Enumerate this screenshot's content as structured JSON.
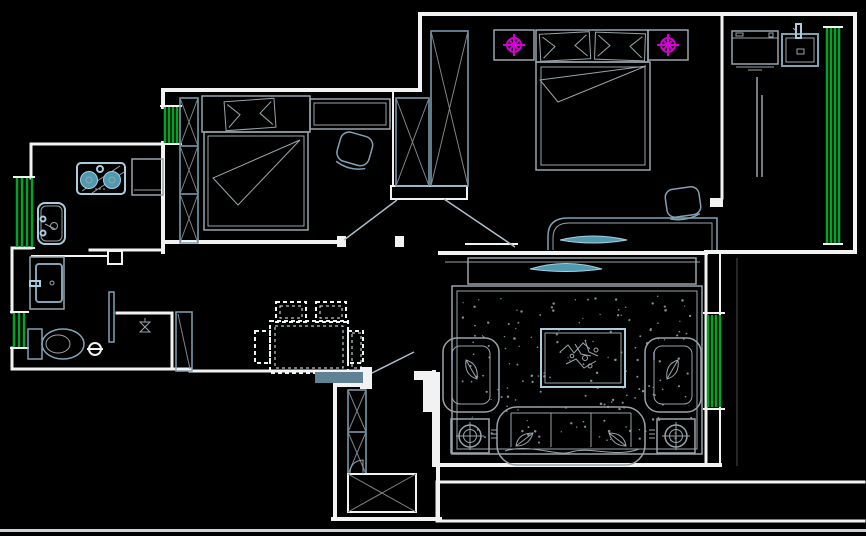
{
  "app": {
    "view": "cad-floor-plan-canvas"
  },
  "canvas": {
    "width": 866,
    "height": 536,
    "background": "#000000"
  },
  "palette": {
    "bg": "#000000",
    "wall": "#f2f2f2",
    "furngray": "#9aa4aa",
    "furncyan": "#7fa3b5",
    "fixture": "#a9cddc",
    "teal": "#4e9ab0",
    "window": "#00a42a",
    "magenta": "#d400d4",
    "dashwhite": "#eef3f6",
    "door": "#aebdc6",
    "xgray": "#7d8488",
    "dimline": "#4a5054",
    "threshold": "#5f8294",
    "strip": "#ccd2d6",
    "rugdot": "#848e94"
  },
  "rug": {
    "dot_count": 170,
    "x": 462,
    "y": 296,
    "w": 232,
    "h": 148
  },
  "floor_plan": {
    "windows": [
      {
        "id": "bedroom2-west-window"
      },
      {
        "id": "kitchen-west-window"
      },
      {
        "id": "bathroom-west-window"
      },
      {
        "id": "living-east-window"
      },
      {
        "id": "balcony-east-window"
      }
    ],
    "doors": [
      {
        "id": "entry-door"
      },
      {
        "id": "bedroom2-door"
      },
      {
        "id": "master-bedroom-door"
      },
      {
        "id": "bathroom-door"
      },
      {
        "id": "balcony-opening"
      }
    ],
    "fixtures": [
      {
        "id": "gas-stove"
      },
      {
        "id": "kitchen-sink"
      },
      {
        "id": "fridge-counter"
      },
      {
        "id": "bathroom-basin"
      },
      {
        "id": "toilet"
      },
      {
        "id": "floor-drain"
      },
      {
        "id": "shower-head"
      },
      {
        "id": "washing-machine"
      },
      {
        "id": "laundry-sink"
      }
    ],
    "furniture": [
      {
        "id": "bedroom2-wardrobe"
      },
      {
        "id": "bedroom2-bed"
      },
      {
        "id": "bedroom2-desk"
      },
      {
        "id": "bedroom2-chair"
      },
      {
        "id": "hall-closet"
      },
      {
        "id": "master-wardrobe"
      },
      {
        "id": "master-bed"
      },
      {
        "id": "nightstand-left"
      },
      {
        "id": "nightstand-right"
      },
      {
        "id": "ceiling-light-left"
      },
      {
        "id": "ceiling-light-right"
      },
      {
        "id": "master-desk"
      },
      {
        "id": "master-chair"
      },
      {
        "id": "tv-cabinet"
      },
      {
        "id": "television"
      },
      {
        "id": "area-rug"
      },
      {
        "id": "coffee-table"
      },
      {
        "id": "plant-decor"
      },
      {
        "id": "armchair-left"
      },
      {
        "id": "armchair-right"
      },
      {
        "id": "sofa"
      },
      {
        "id": "lamp-table-left"
      },
      {
        "id": "lamp-table-right"
      },
      {
        "id": "dining-table"
      },
      {
        "id": "dining-chair-1"
      },
      {
        "id": "dining-chair-2"
      },
      {
        "id": "dining-chair-3"
      },
      {
        "id": "dining-chair-4"
      },
      {
        "id": "shoe-cabinet-tall"
      },
      {
        "id": "entry-cabinet"
      },
      {
        "id": "doorway-threshold"
      }
    ]
  }
}
